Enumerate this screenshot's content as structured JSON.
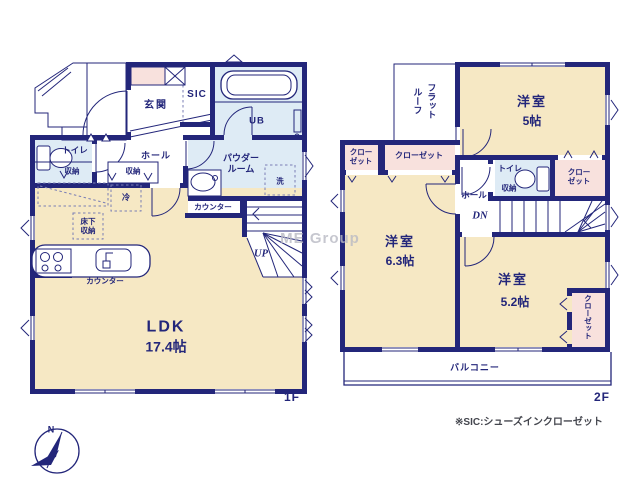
{
  "title": "floor-plan",
  "f1": {
    "floor_label": "1F",
    "genkan": "玄関",
    "sic": "SIC",
    "ub": "UB",
    "toilet": "トイレ",
    "toilet_storage": "収納",
    "hall_storage": "収納",
    "hall": "ホール",
    "powder_line1": "パウダー",
    "powder_line2": "ルーム",
    "laundry": "洗",
    "counter_powder": "カウンター",
    "fridge": "冷",
    "underfloor_line1": "床下",
    "underfloor_line2": "収納",
    "counter_kitchen": "カウンター",
    "up": "UP",
    "ldk": "LDK",
    "ldk_size": "17.4帖"
  },
  "f2": {
    "floor_label": "2F",
    "flatroof_line1": "フラット",
    "flatroof_line2": "ルーフ",
    "room5": "洋室",
    "room5_size": "5帖",
    "closet_nw_line1": "クロー",
    "closet_nw_line2": "ゼット",
    "closet_n": "クローゼット",
    "room63": "洋室",
    "room63_size": "6.3帖",
    "hall": "ホール",
    "dn": "DN",
    "toilet": "トイレ",
    "toilet_storage": "収納",
    "closet_e_line1": "クロー",
    "closet_e_line2": "ゼット",
    "room52": "洋室",
    "room52_size": "5.2帖",
    "closet_se": "クローゼット",
    "balcony": "バルコニー"
  },
  "footer": {
    "note": "※SIC:シューズインクローゼット",
    "compass_n": "N"
  },
  "watermark": "ME Group",
  "colors": {
    "wall_navy": "#23267A",
    "room_cream": "#F6E8C4",
    "wet_area_blue": "#DEEBF5",
    "closet_pink": "#F8E1DD",
    "watermark_gray": "#B9BAC4"
  }
}
